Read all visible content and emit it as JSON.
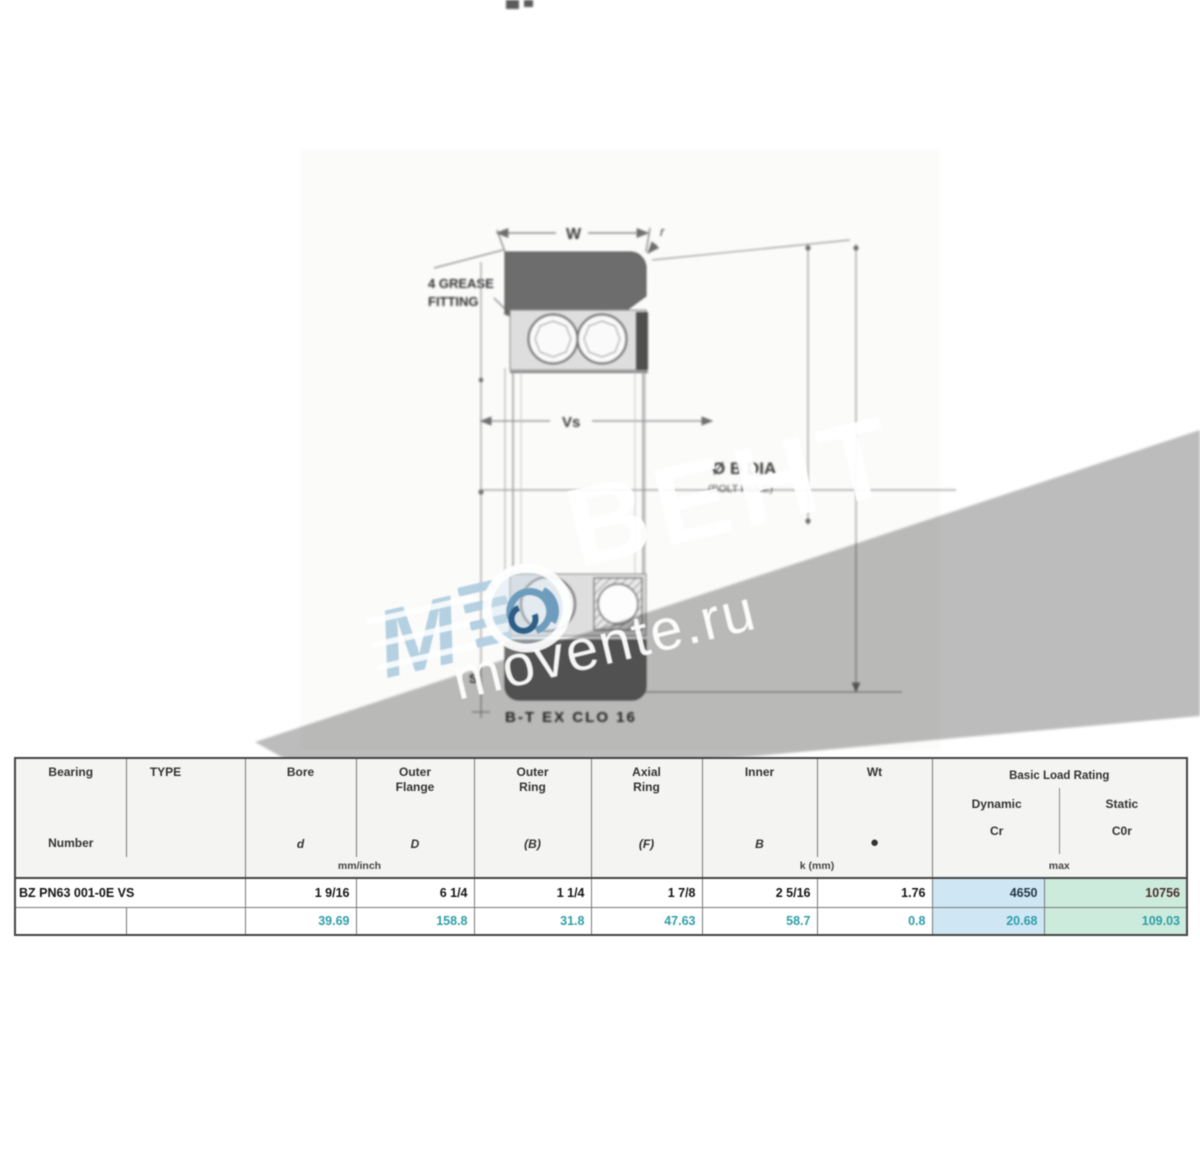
{
  "watermark": {
    "brand": "ВЕНТ",
    "site": "movente.ru",
    "logo_letter": "M"
  },
  "drawing": {
    "dim_top": "W",
    "dim_corner": "r",
    "dim_mid": "Vs",
    "note_line1": "4 GREASE",
    "note_line2": "FITTING",
    "dia_label": "Ø B DIA",
    "dia_sub": "(BOLT HOLE)",
    "dim_s": "S",
    "bottom_note": "B-T EX CLO 16"
  },
  "table": {
    "headers": {
      "bearing_line1": "Bearing",
      "bearing_line2": "Number",
      "type": "TYPE",
      "bore_name": "Bore",
      "bore_sym": "d",
      "flange_name1": "Outer",
      "flange_name2": "Flange",
      "flange_sym": "D",
      "ring_name1": "Outer",
      "ring_name2": "Ring",
      "ring_sym": "(B)",
      "axial_name1": "Axial",
      "axial_name2": "Ring",
      "axial_sym": "(F)",
      "inner_name": "Inner",
      "inner_sym": "B",
      "weight_name": "Wt",
      "weight_sym": "●",
      "load_title": "Basic Load Rating",
      "load_dyn_name": "Dynamic",
      "load_dyn_sym": "Cr",
      "load_stat_name": "Static",
      "load_stat_sym": "C0r"
    },
    "units": {
      "mm_inch": "mm/inch",
      "k_mm": "k (mm)",
      "max": "max"
    },
    "row_inch": {
      "number": "BZ PN63 001-0E VS",
      "bore": "1 9/16",
      "flange": "6 1/4",
      "ring": "1 1/4",
      "axial": "1 7/8",
      "inner": "2 5/16",
      "weight": "1.76",
      "dynamic": "4650",
      "static": "10756"
    },
    "row_mm": {
      "bore": "39.69",
      "flange": "158.8",
      "ring": "31.8",
      "axial": "47.63",
      "inner": "58.7",
      "weight": "0.8",
      "dynamic": "20.68",
      "static": "109.03"
    }
  },
  "colors": {
    "teal_text": "#2f9ea8",
    "highlight_blue": "#cfe7f5",
    "highlight_green": "#cdebdc",
    "watermark_gray": "#bcbcbc",
    "logo_blue": "#aeccdf"
  }
}
